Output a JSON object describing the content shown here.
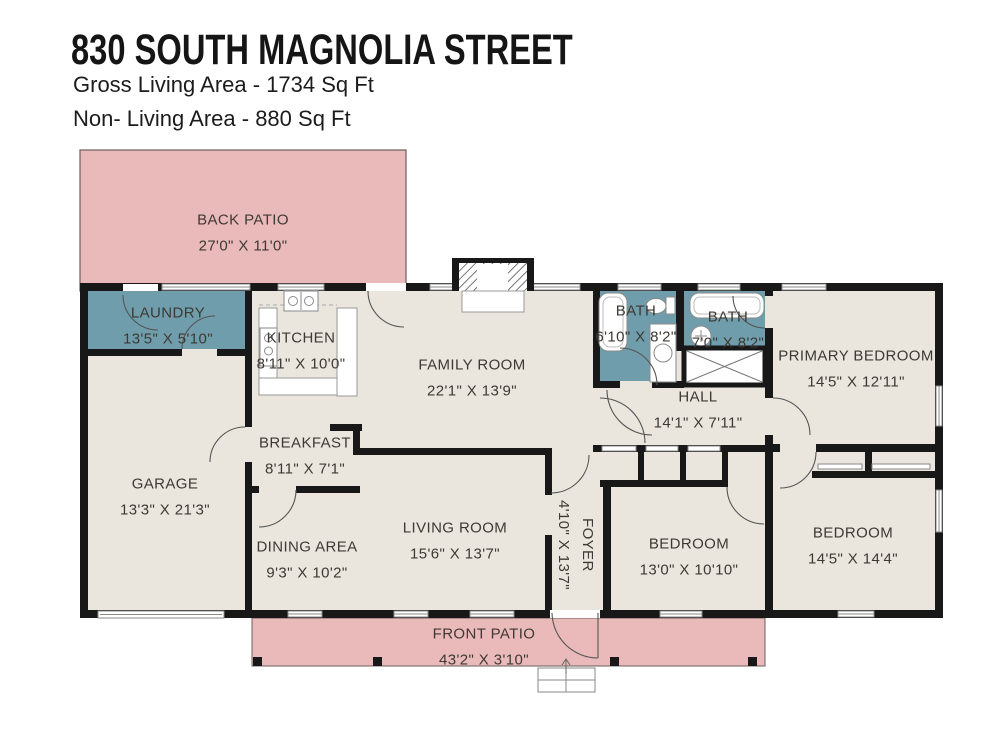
{
  "header": {
    "address": "830 SOUTH MAGNOLIA STREET",
    "gross_living_area": "Gross Living Area - 1734 Sq Ft",
    "non_living_area": "Non- Living Area - 880 Sq Ft"
  },
  "rooms": {
    "back_patio": {
      "name": "BACK PATIO",
      "dims": "27'0\" X 11'0\""
    },
    "laundry": {
      "name": "LAUNDRY",
      "dims": "13'5\" X 5'10\""
    },
    "kitchen": {
      "name": "KITCHEN",
      "dims": "8'11\" X 10'0\""
    },
    "family_room": {
      "name": "FAMILY ROOM",
      "dims": "22'1\" X 13'9\""
    },
    "bath_hall": {
      "name": "BATH",
      "dims": "6'10\" X 8'2\""
    },
    "bath_primary": {
      "name": "BATH",
      "dims": "7'0\" X 8'2\""
    },
    "primary_bedroom": {
      "name": "PRIMARY BEDROOM",
      "dims": "14'5\" X 12'11\""
    },
    "hall": {
      "name": "HALL",
      "dims": "14'1\" X 7'11\""
    },
    "garage": {
      "name": "GARAGE",
      "dims": "13'3\" X 21'3\""
    },
    "breakfast": {
      "name": "BREAKFAST",
      "dims": "8'11\" X 7'1\""
    },
    "dining_area": {
      "name": "DINING AREA",
      "dims": "9'3\" X 10'2\""
    },
    "living_room": {
      "name": "LIVING ROOM",
      "dims": "15'6\" X 13'7\""
    },
    "foyer": {
      "name": "FOYER",
      "dims": "4'10\" X 13'7\""
    },
    "bedroom_center": {
      "name": "BEDROOM",
      "dims": "13'0\" X 10'10\""
    },
    "bedroom_right": {
      "name": "BEDROOM",
      "dims": "14'5\" X 14'4\""
    },
    "front_patio": {
      "name": "FRONT PATIO",
      "dims": "43'2\" X 3'10\""
    }
  },
  "colors": {
    "patio": "#eab9b9",
    "wet_room": "#6f9dab",
    "floor": "#eae6dd",
    "wall": "#181818",
    "text": "#3d3934"
  }
}
